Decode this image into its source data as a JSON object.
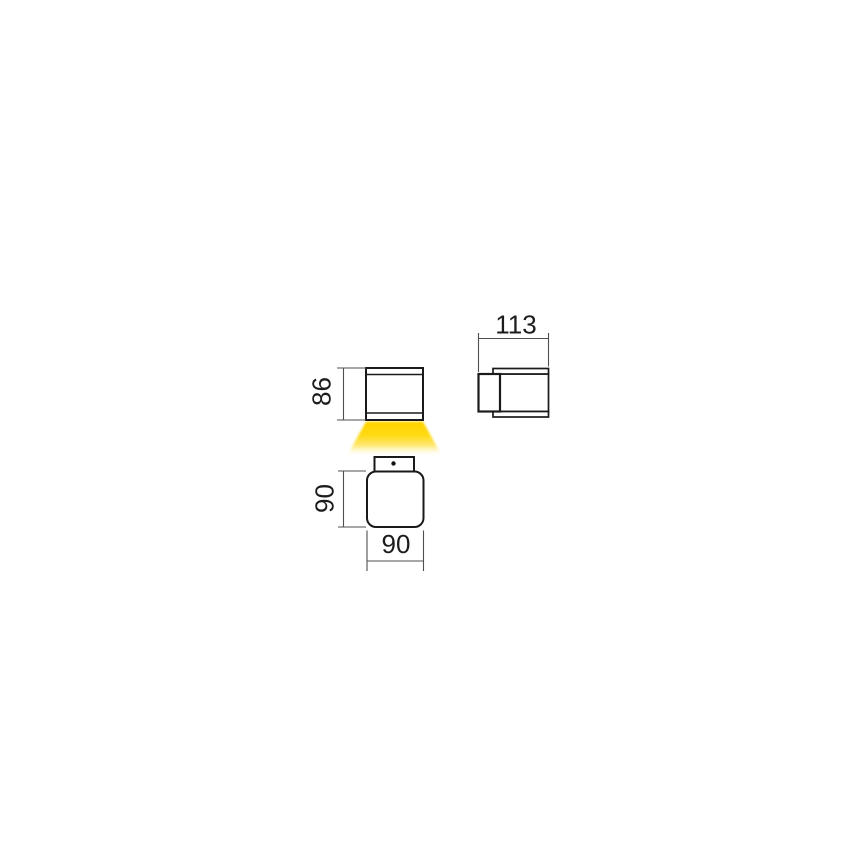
{
  "drawing": {
    "type": "technical-dimension-drawing",
    "subject": "square wall luminaire with downward light beam, three orthographic views",
    "dimensions": {
      "side_width": "113",
      "front_height": "86",
      "plan_height": "90",
      "plan_width": "90"
    },
    "colors": {
      "object_line": "#1a1a1a",
      "dimension_line": "#4f4f4f",
      "label_text": "#1c1c1c",
      "beam": "#ffd400",
      "background": "#ffffff"
    }
  }
}
